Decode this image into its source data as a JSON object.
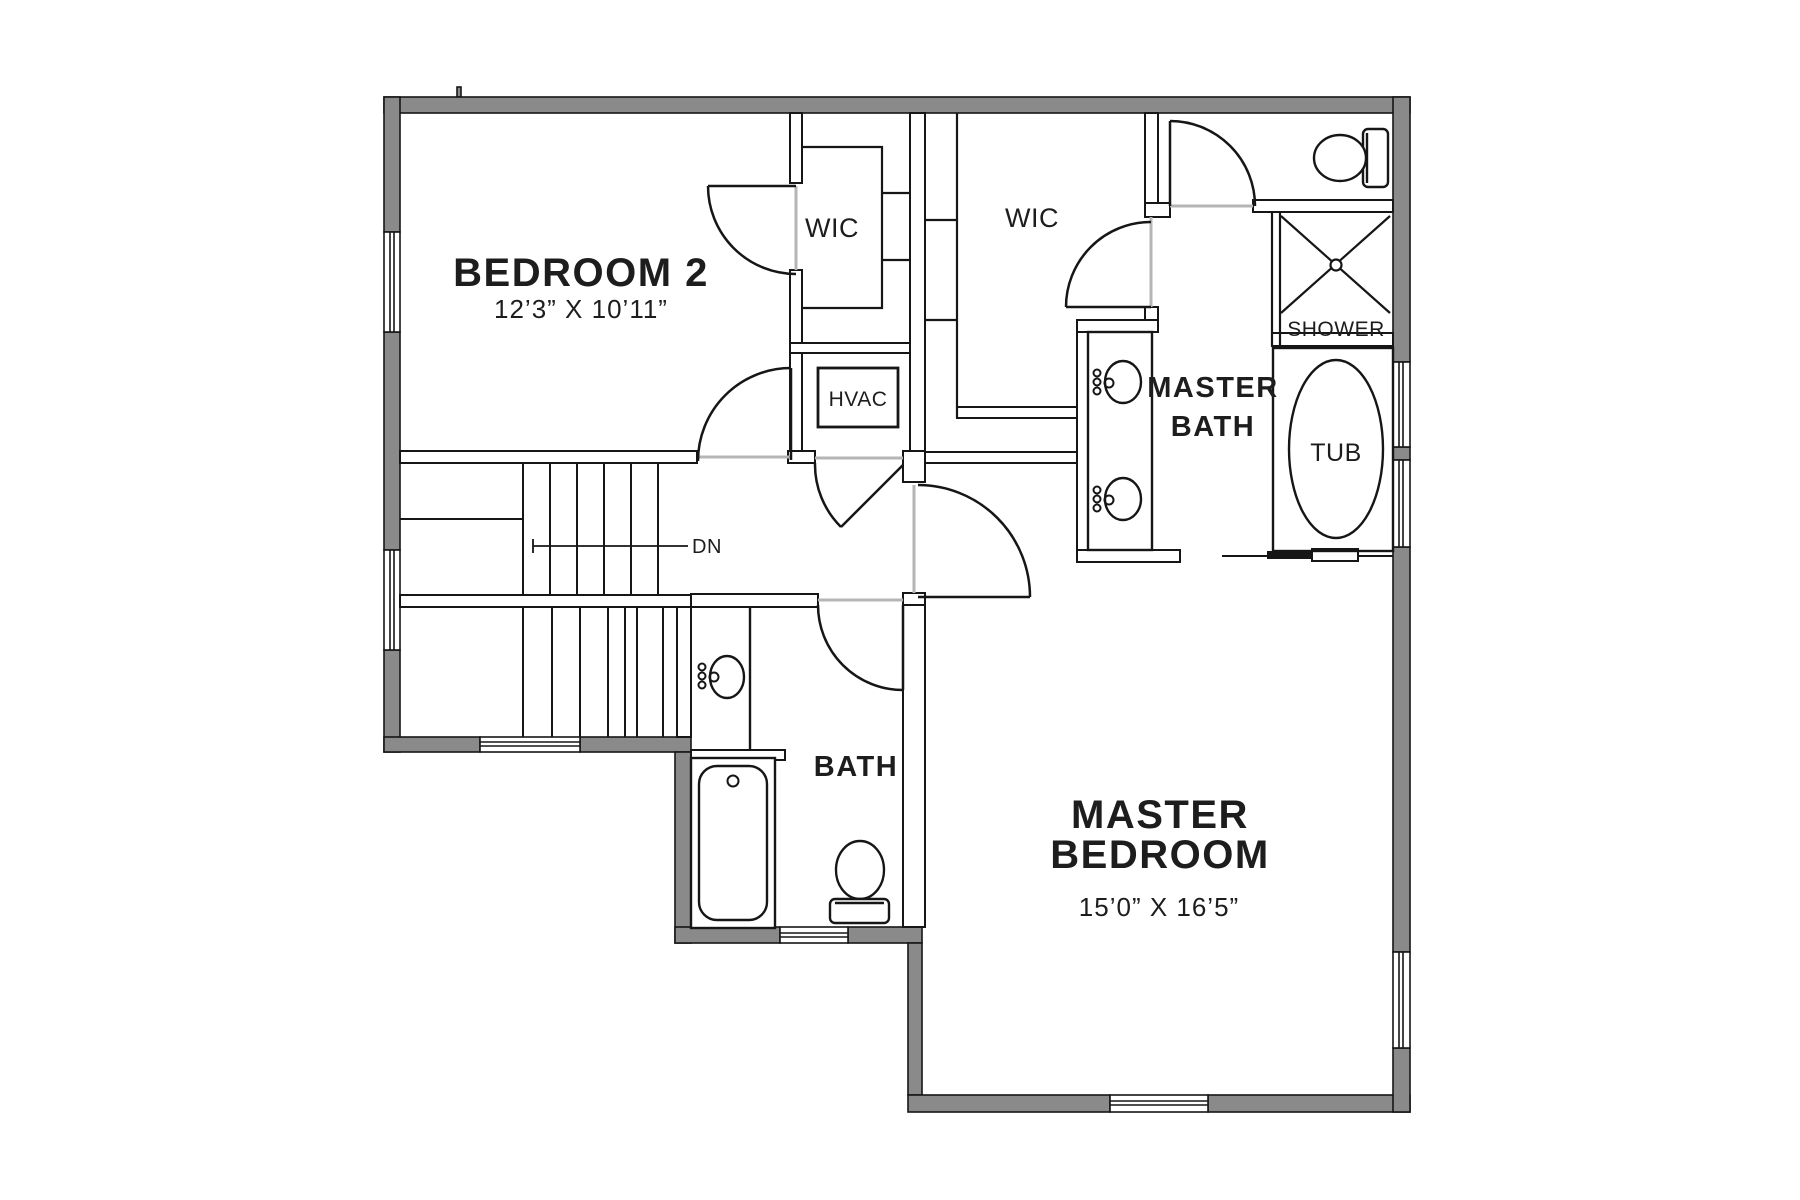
{
  "plan": {
    "type": "floor-plan",
    "floor": "upper floor",
    "colors": {
      "background": "#ffffff",
      "exterior_wall_fill": "#8a8a8a",
      "line": "#161616",
      "door_threshold": "#b5b5b5",
      "text": "#1d1d1d"
    }
  },
  "rooms": {
    "bedroom2": {
      "name": "BEDROOM 2",
      "dims": "12’3” X 10’11”"
    },
    "wic1": {
      "name": "WIC"
    },
    "wic2": {
      "name": "WIC"
    },
    "master_bath": {
      "line1": "MASTER",
      "line2": "BATH"
    },
    "master_bedroom": {
      "line1": "MASTER",
      "line2": "BEDROOM",
      "dims": "15’0” X 16’5”"
    },
    "bath": {
      "name": "BATH"
    },
    "hvac": {
      "name": "HVAC"
    },
    "shower": {
      "name": "SHOWER"
    },
    "tub": {
      "name": "TUB"
    },
    "stairs": {
      "down_label": "DN"
    }
  },
  "fixtures": {
    "wc_toilet": "toilet",
    "bath_toilet": "toilet",
    "master_vanity_sinks": "double-sink-vanity",
    "bath_sink": "sink",
    "bath_tub": "bathtub",
    "master_tub": "soaking-tub",
    "master_shower": "shower",
    "hvac_unit": "hvac-unit",
    "pocket_door": "pocket-door"
  }
}
